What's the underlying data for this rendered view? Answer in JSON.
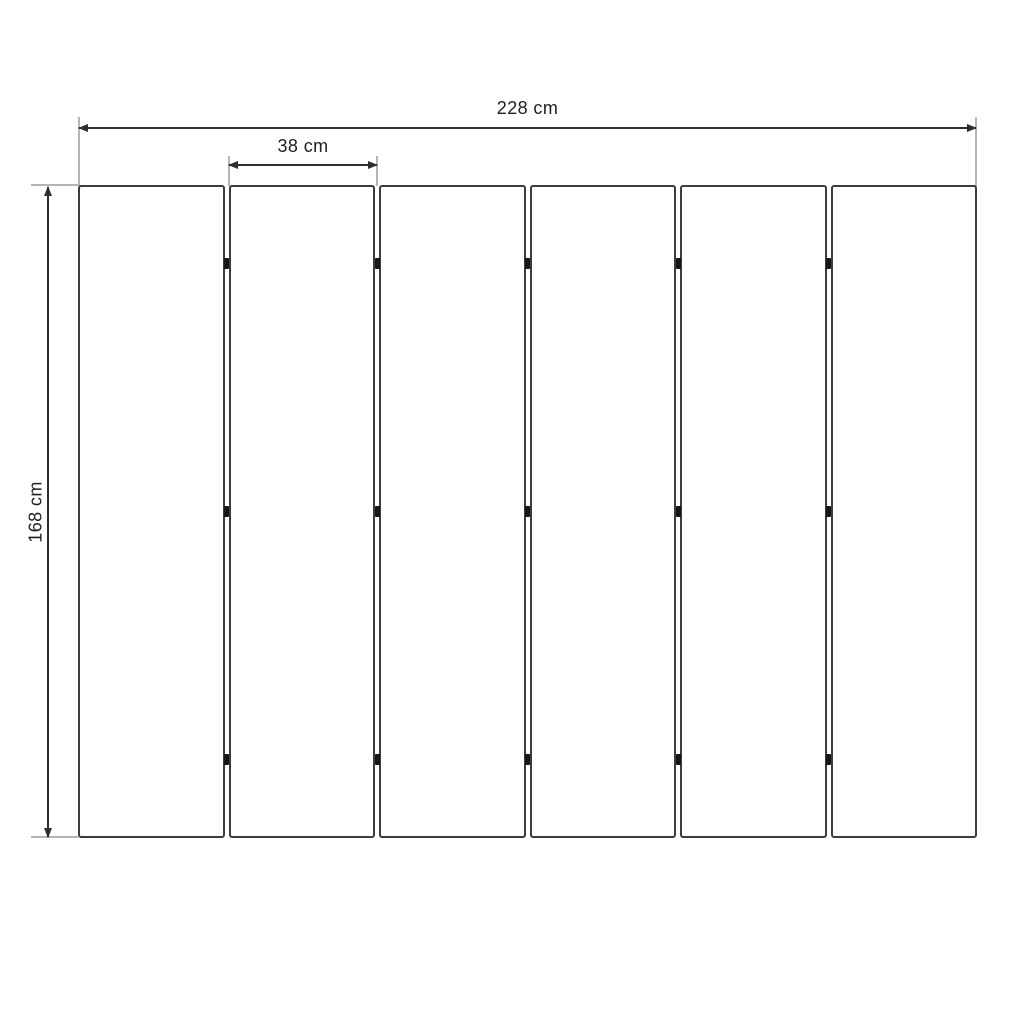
{
  "diagram": {
    "type": "technical-dimension-drawing",
    "panels": {
      "count": 6,
      "hinge_rows_pct": [
        12,
        50,
        88
      ],
      "hinges_per_gap": 3
    },
    "dimensions": {
      "total_width": {
        "label": "228 cm"
      },
      "panel_width": {
        "label": "38 cm"
      },
      "height": {
        "label": "168 cm"
      }
    },
    "colors": {
      "line": "#2e2e2e",
      "extension": "#b5b5b5",
      "panel_border": "#3c3c3c",
      "hinge": "#161616",
      "text": "#1e1e1e",
      "background": "#ffffff"
    }
  }
}
